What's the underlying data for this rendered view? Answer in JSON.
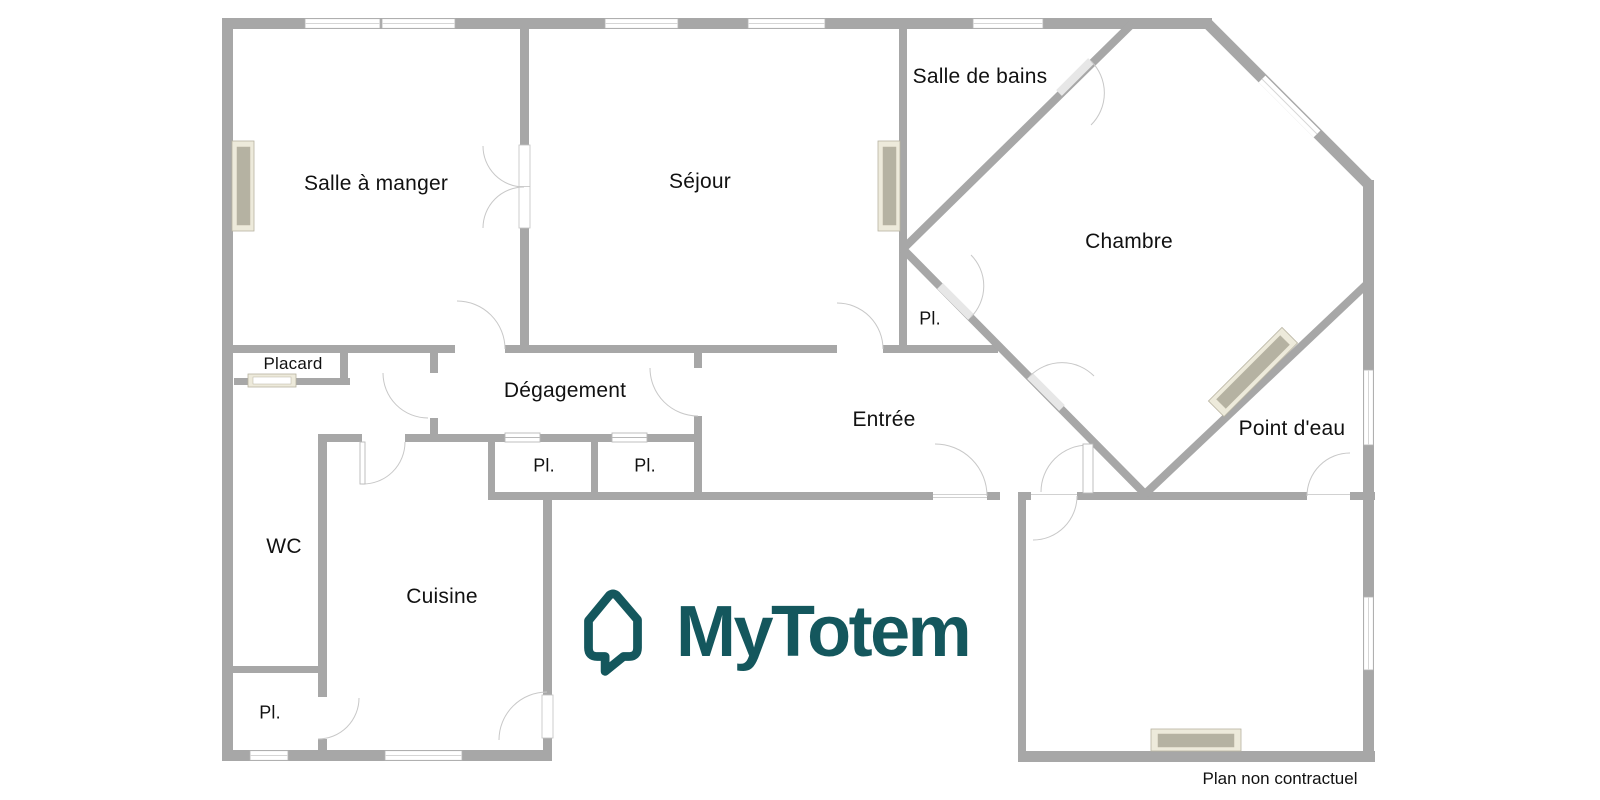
{
  "branding": {
    "logo_text": "MyTotem",
    "accent_color": "#14575d"
  },
  "footer": {
    "disclaimer": "Plan non contractuel"
  },
  "colors": {
    "wall": "#a7a7a7",
    "door_arc": "#c8c8c8",
    "opening": "#e7e7e7",
    "window_frame": "#b3b3b3",
    "radiator_frame_fill": "#edeadb",
    "radiator_frame_stroke": "#b7b3a1",
    "radiator_inner": "#b5b2a2",
    "label_color": "#111111"
  },
  "rooms": [
    {
      "id": "salle-a-manger",
      "name": "Salle à manger"
    },
    {
      "id": "sejour",
      "name": "Séjour"
    },
    {
      "id": "salle-de-bains",
      "name": "Salle de bains"
    },
    {
      "id": "chambre",
      "name": "Chambre"
    },
    {
      "id": "placard-chambre",
      "name": "Pl."
    },
    {
      "id": "degagement",
      "name": "Dégagement"
    },
    {
      "id": "entree",
      "name": "Entrée"
    },
    {
      "id": "point-d-eau",
      "name": "Point d'eau"
    },
    {
      "id": "placard-1",
      "name": "Pl."
    },
    {
      "id": "placard-2",
      "name": "Pl."
    },
    {
      "id": "placard",
      "name": "Placard"
    },
    {
      "id": "wc",
      "name": "WC"
    },
    {
      "id": "cuisine",
      "name": "Cuisine"
    },
    {
      "id": "placard-wc",
      "name": "Pl."
    }
  ]
}
